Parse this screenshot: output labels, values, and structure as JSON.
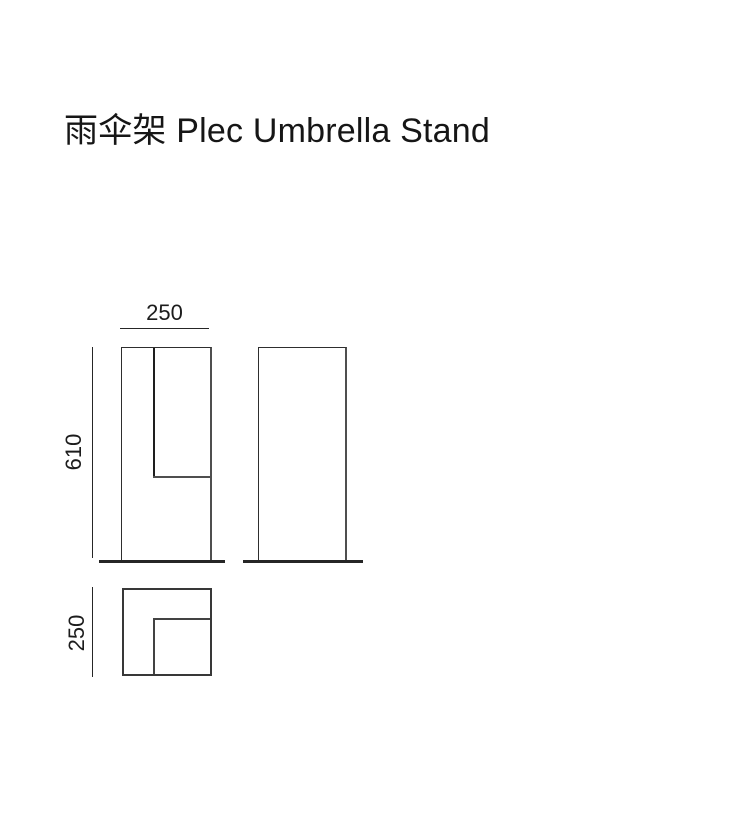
{
  "page": {
    "title": "雨伞架 Plec Umbrella Stand",
    "background_color": "#ffffff"
  },
  "diagram": {
    "dimension_labels": {
      "width": "250",
      "height": "610",
      "depth": "250"
    },
    "colors": {
      "thin_line": "#2e2e2e",
      "medium_line": "#4f4f4f",
      "thick_line": "#262626",
      "text": "#1c1c1c",
      "title_text": "#161616"
    }
  }
}
